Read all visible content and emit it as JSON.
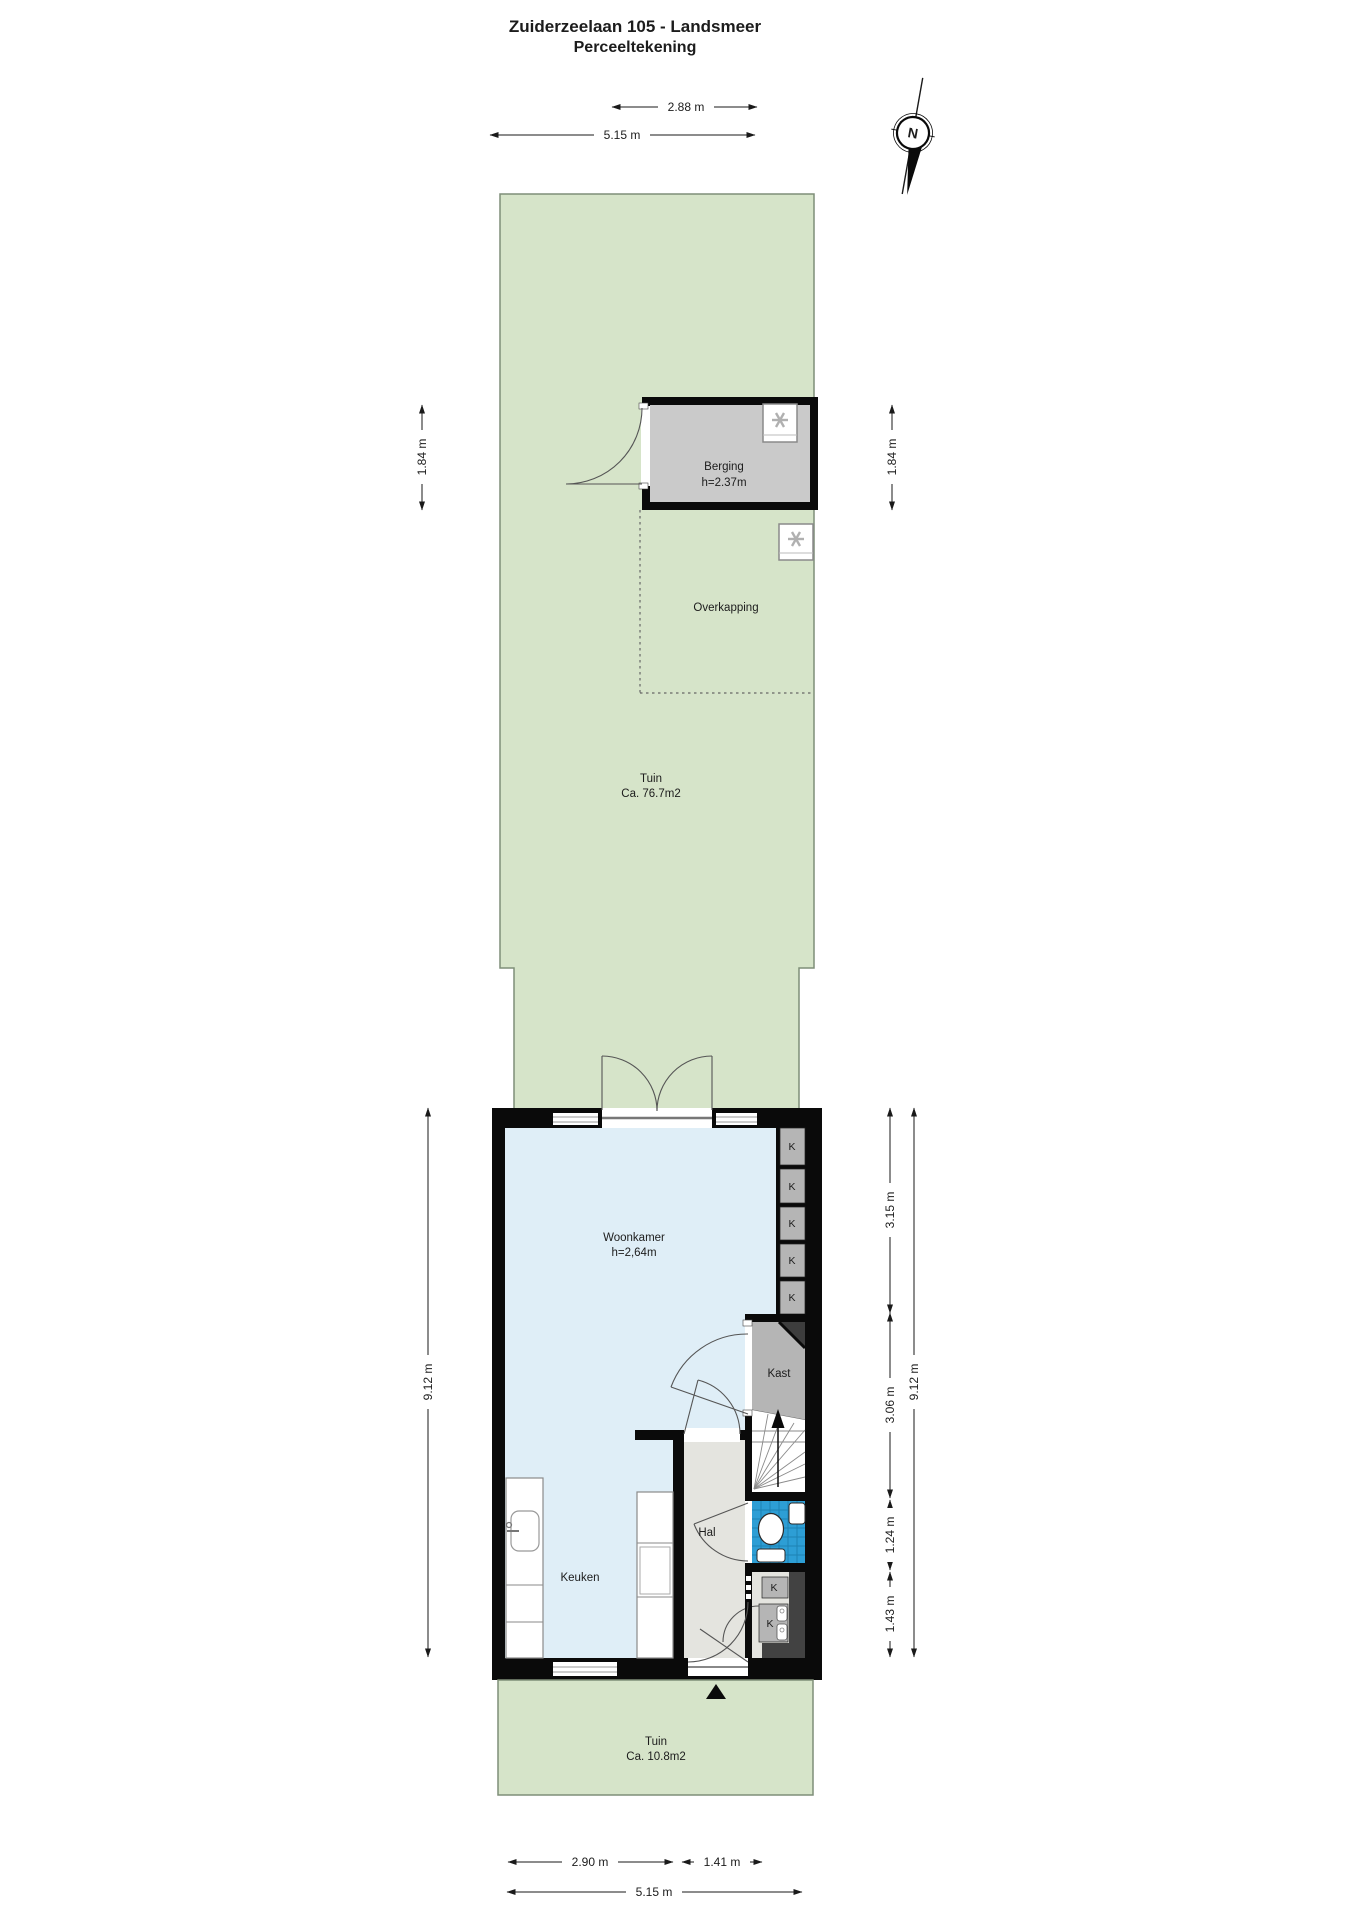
{
  "title": {
    "line1": "Zuiderzeelaan 105 - Landsmeer",
    "line2": "Perceeltekening"
  },
  "compass": {
    "north_label": "N"
  },
  "rooms": {
    "berging": {
      "name": "Berging",
      "height": "h=2.37m"
    },
    "overkapping": {
      "name": "Overkapping"
    },
    "tuin_back": {
      "name": "Tuin",
      "area": "Ca. 76.7m2"
    },
    "woonkamer": {
      "name": "Woonkamer",
      "height": "h=2,64m"
    },
    "kast": {
      "name": "Kast"
    },
    "hal": {
      "name": "Hal"
    },
    "keuken": {
      "name": "Keuken"
    },
    "tuin_front": {
      "name": "Tuin",
      "area": "Ca. 10.8m2"
    },
    "closet_label": "K"
  },
  "dimensions": {
    "top": [
      {
        "label": "2.88 m"
      },
      {
        "label": "5.15 m"
      }
    ],
    "left": [
      {
        "label": "1.84 m"
      },
      {
        "label": "9.12 m"
      }
    ],
    "right": [
      {
        "label": "1.84 m"
      },
      {
        "label": "3.15 m"
      },
      {
        "label": "3.06 m"
      },
      {
        "label": "1.24 m"
      },
      {
        "label": "1.43 m"
      },
      {
        "label": "9.12 m"
      }
    ],
    "bottom": [
      {
        "label": "2.90 m"
      },
      {
        "label": "1.41 m"
      },
      {
        "label": "5.15 m"
      }
    ]
  },
  "colors": {
    "garden_green": "#d6e4c9",
    "garden_border": "#7f8e78",
    "floor_blue": "#dfeef7",
    "floor_hal": "#e4e4df",
    "room_gray": "#cacaca",
    "closet_gray": "#b5b5b5",
    "bath_blue": "#2d9ed5",
    "dark_gray": "#424242",
    "wall_black": "#0a0a0a"
  }
}
